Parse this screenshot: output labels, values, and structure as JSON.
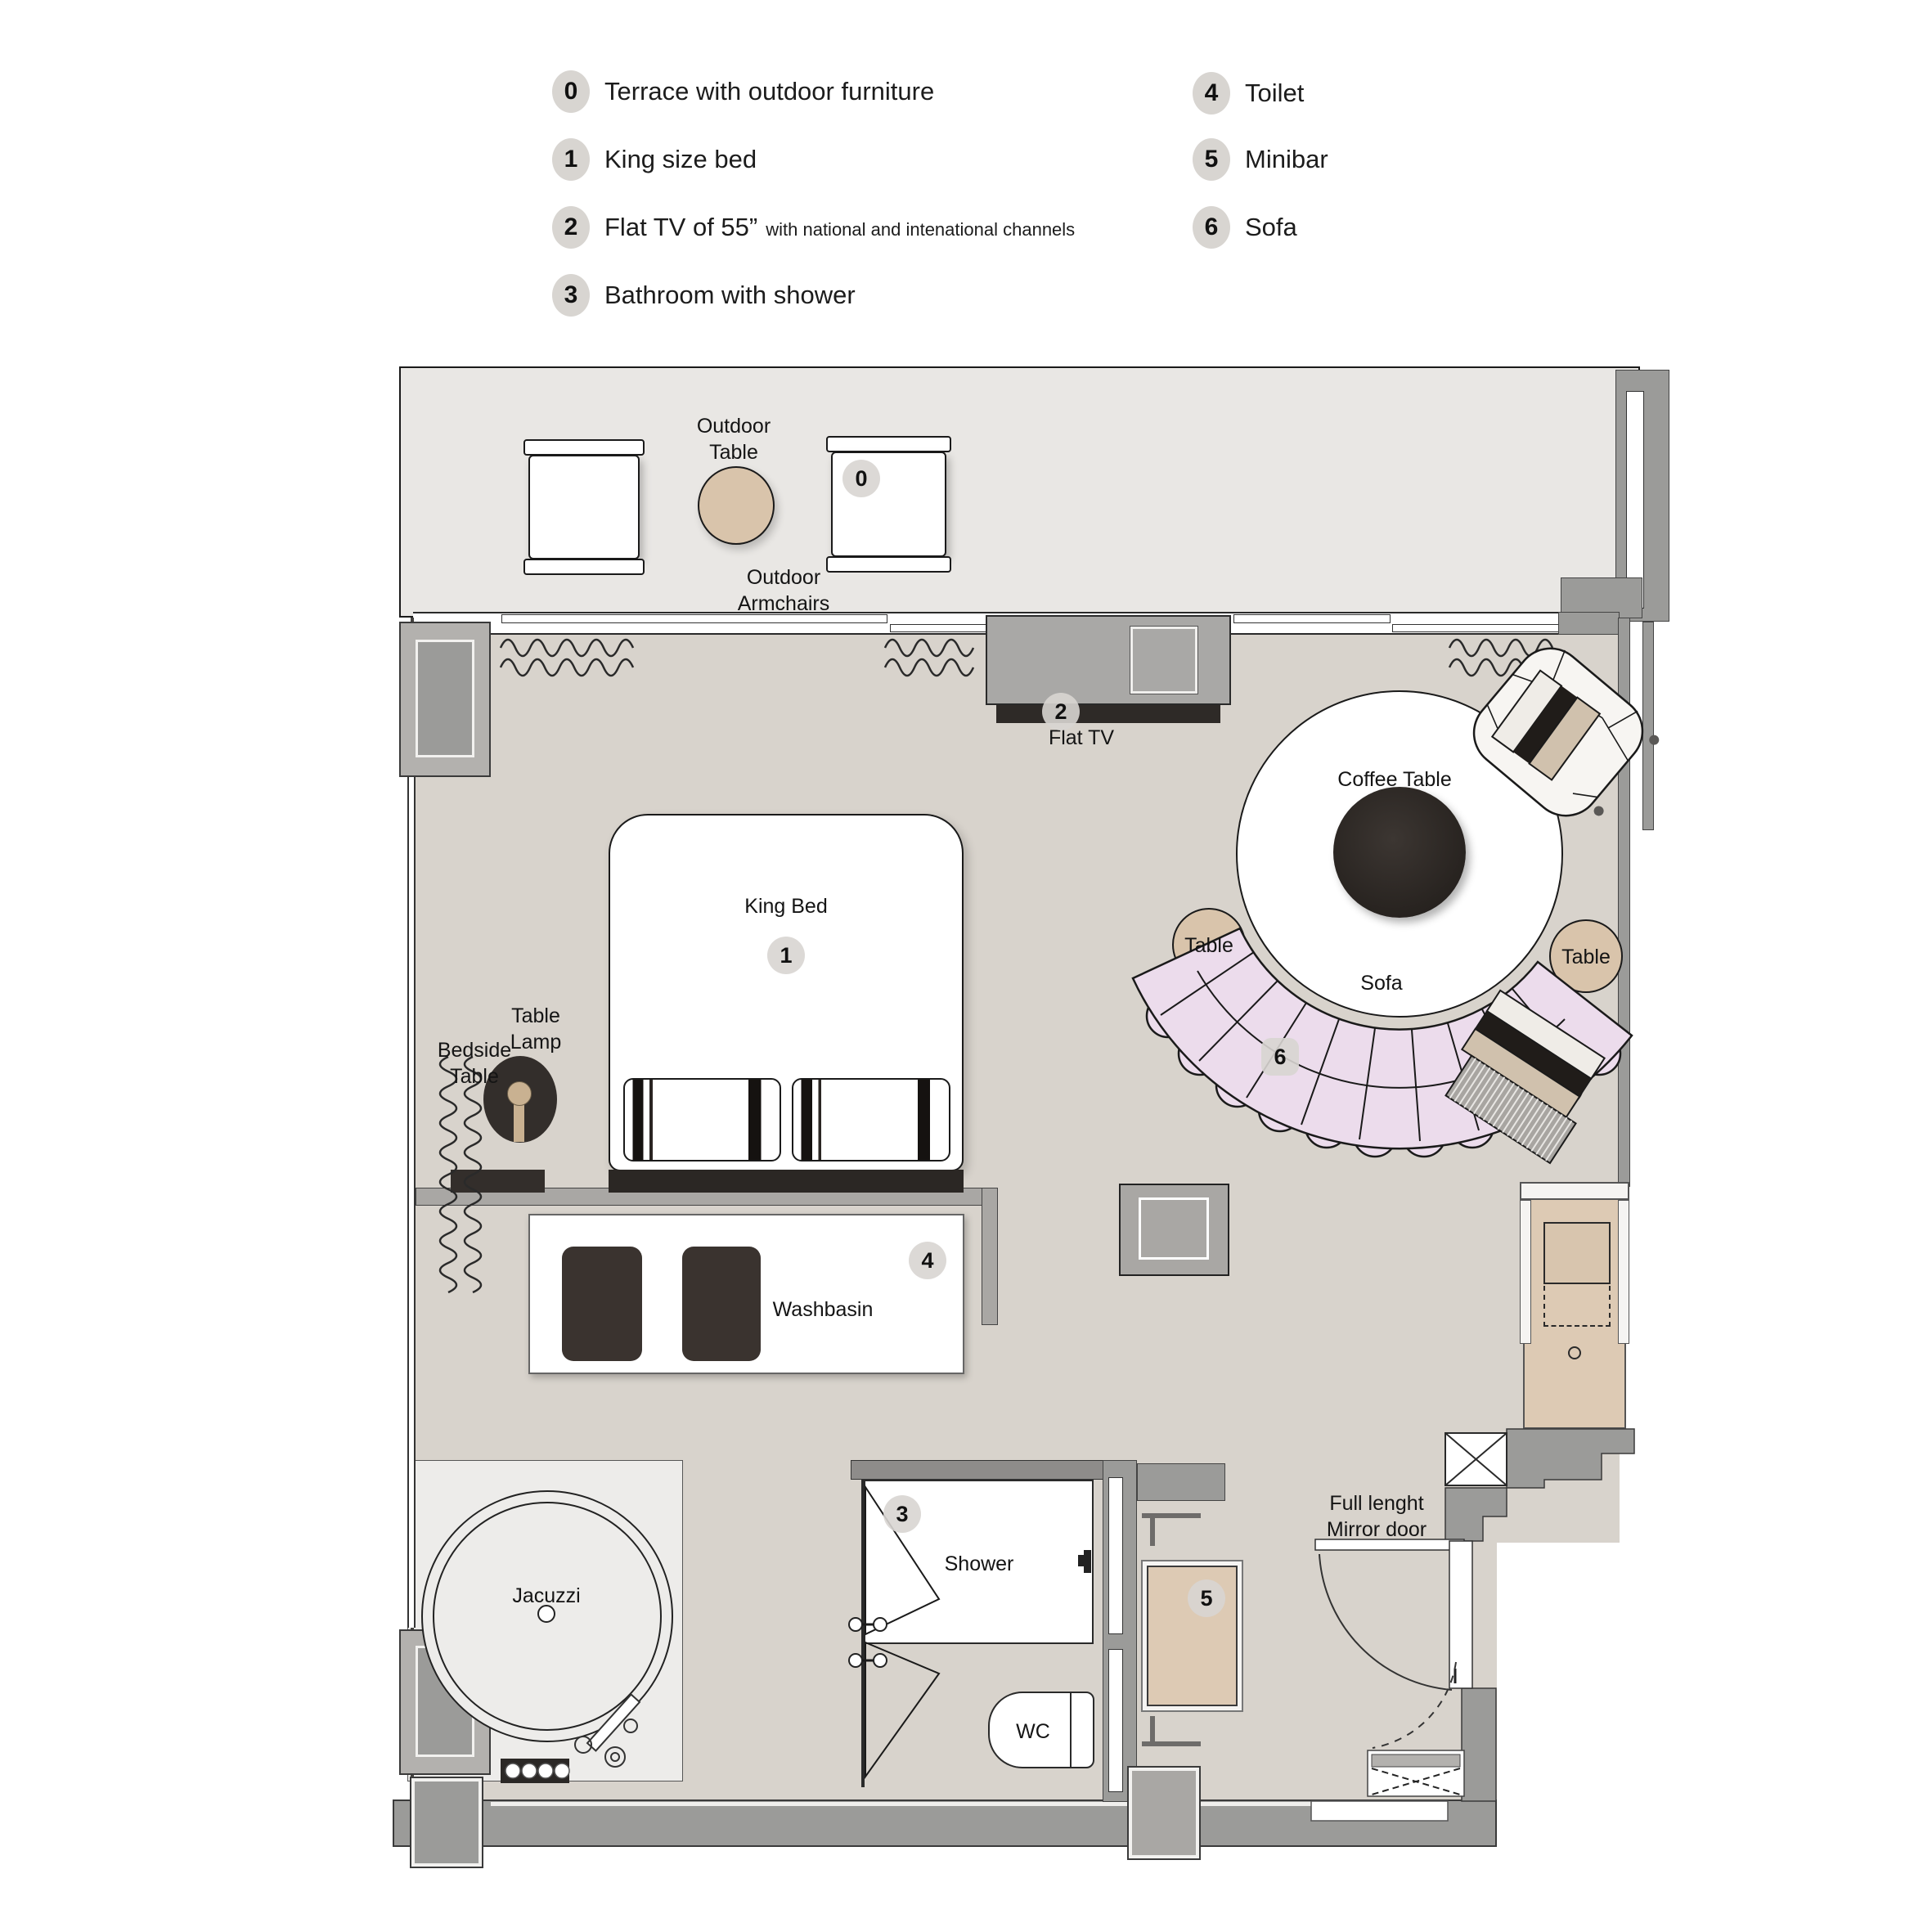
{
  "legend": {
    "items": [
      {
        "num": "0",
        "label": "Terrace with outdoor furniture",
        "suffix": ""
      },
      {
        "num": "1",
        "label": "King size bed",
        "suffix": ""
      },
      {
        "num": "2",
        "label": "Flat TV of 55”",
        "suffix": "with national and intenational channels"
      },
      {
        "num": "3",
        "label": "Bathroom with shower",
        "suffix": ""
      },
      {
        "num": "4",
        "label": "Toilet",
        "suffix": ""
      },
      {
        "num": "5",
        "label": "Minibar",
        "suffix": ""
      },
      {
        "num": "6",
        "label": "Sofa",
        "suffix": ""
      }
    ]
  },
  "plan": {
    "badges": {
      "terrace": "0",
      "bed": "1",
      "tv": "2",
      "shower": "3",
      "washbasin": "4",
      "minibar": "5",
      "sofa": "6"
    },
    "labels": {
      "outdoor_table": "Outdoor Table",
      "outdoor_armchairs": "Outdoor Armchairs",
      "flat_tv": "Flat TV",
      "king_bed": "King Bed",
      "table_lamp": "Table Lamp",
      "bedside_table": "Bedside Table",
      "coffee_table": "Coffee Table",
      "sofa": "Sofa",
      "table_left": "Table",
      "table_right": "Table",
      "washbasin": "Washbasin",
      "jacuzzi": "Jacuzzi",
      "shower": "Shower",
      "wc": "WC",
      "mirror_door": "Full lenght Mirror door"
    },
    "colors": {
      "room_floor": "#d8d3cc",
      "terrace_floor": "#e9e7e4",
      "wall": "#9b9b99",
      "sofa_pink": "#ecdcec",
      "wood_tan": "#d9c4ab",
      "dark_furniture": "#332e2b",
      "badge_bg": "#d8d5d1"
    }
  }
}
